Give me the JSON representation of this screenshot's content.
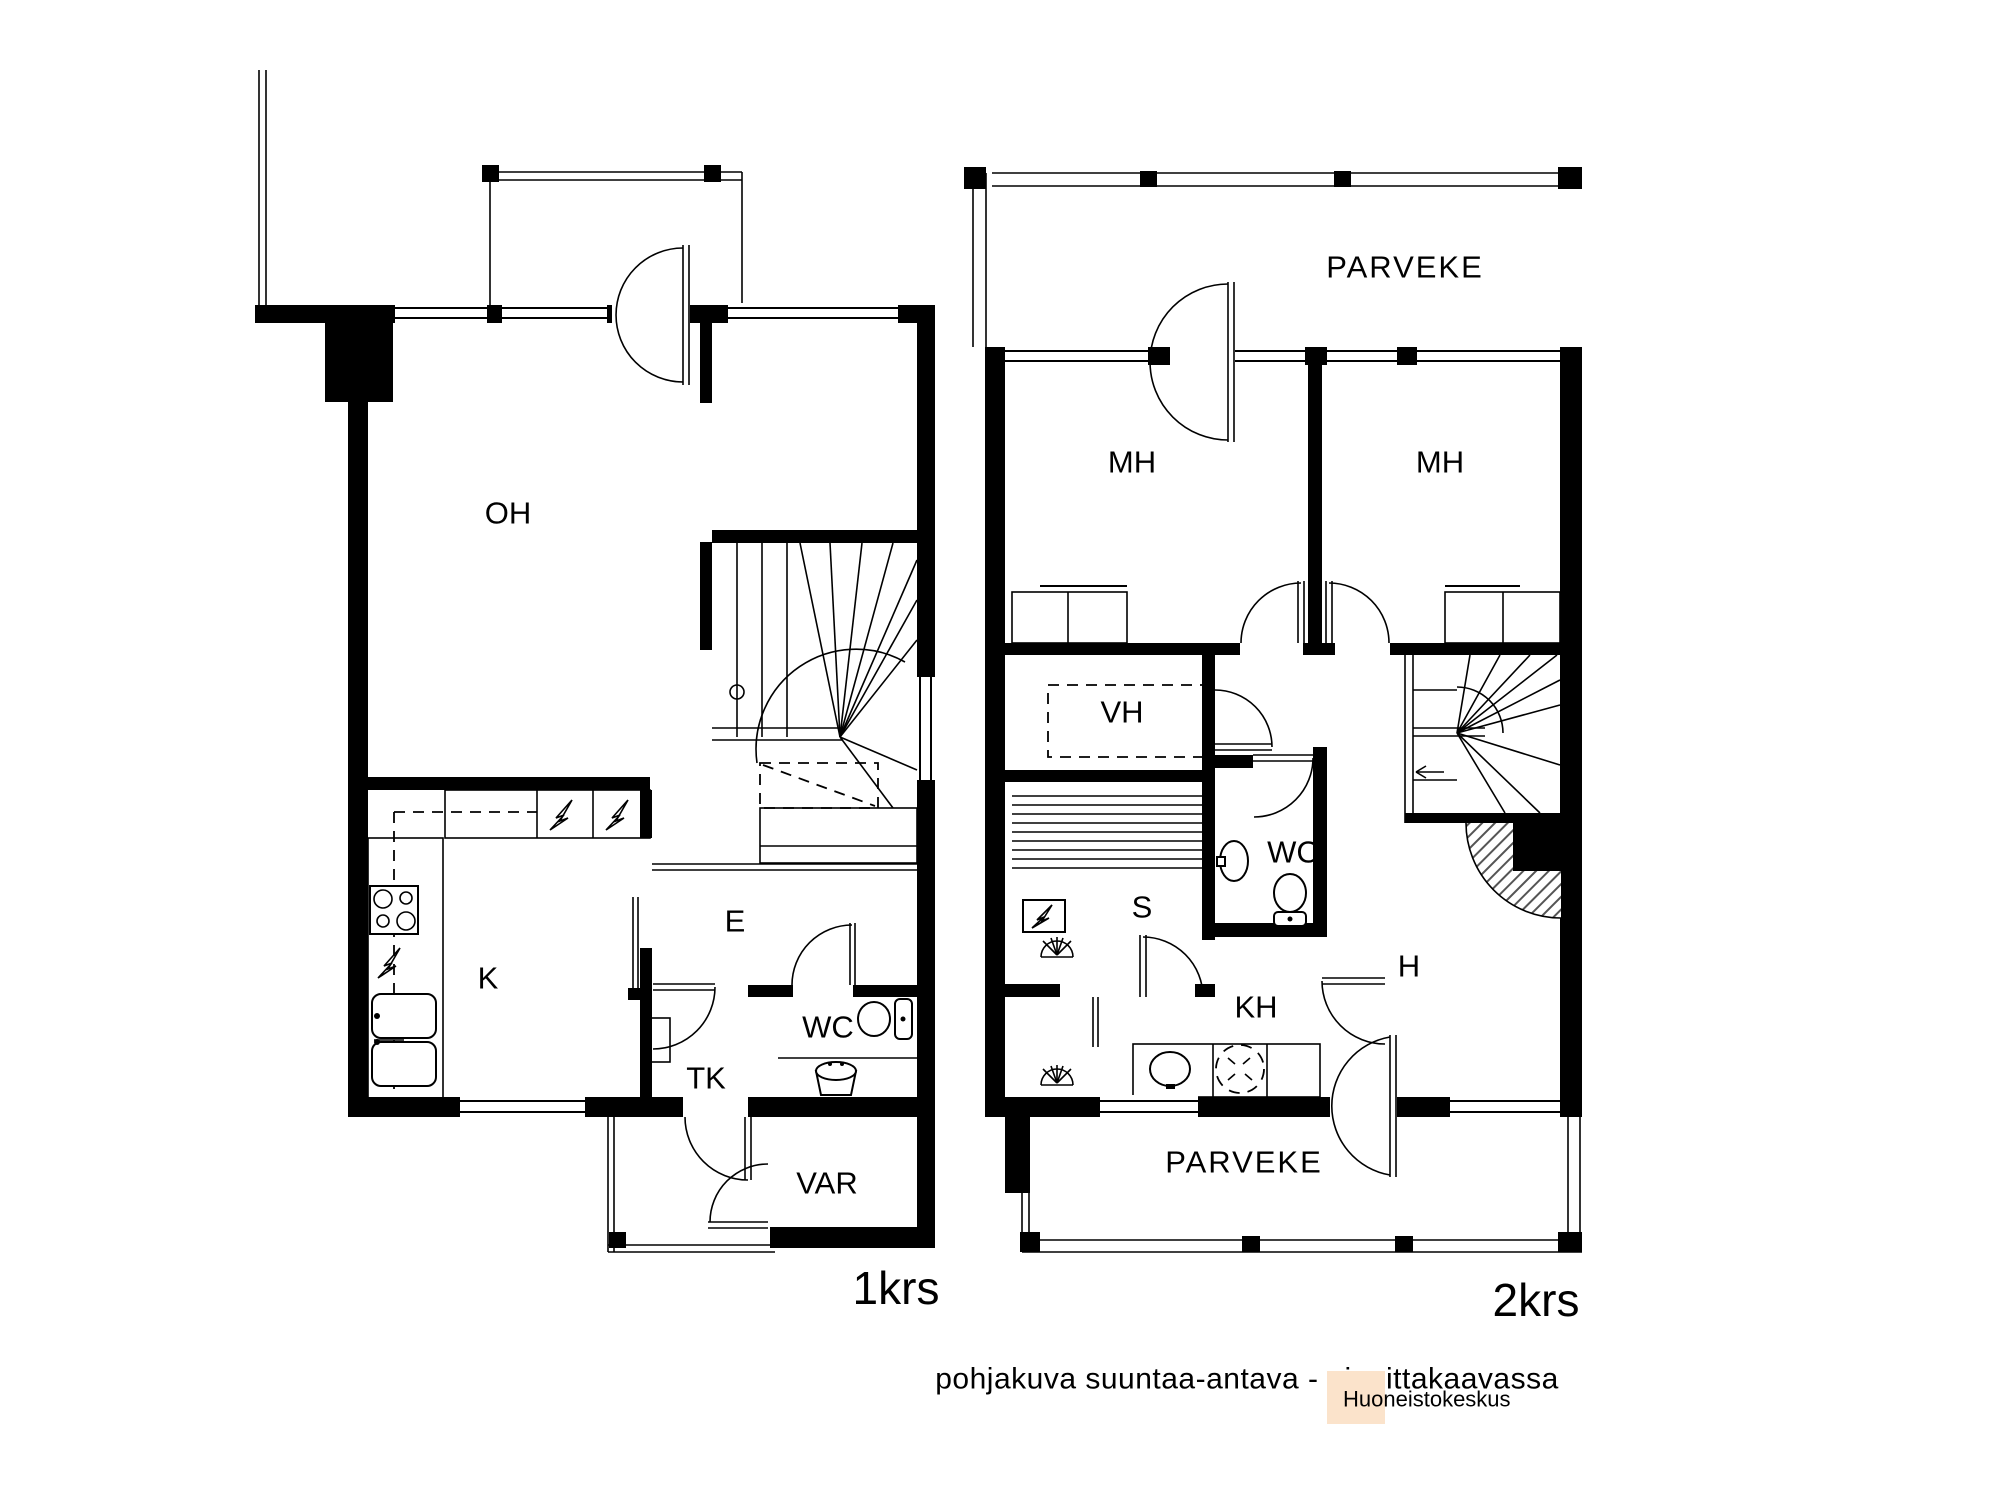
{
  "document": {
    "type": "floorplan",
    "floors_count": "2"
  },
  "floor1": {
    "label": "1krs",
    "rooms": {
      "oh": "OH",
      "k": "K",
      "e": "E",
      "tk": "TK",
      "wc": "WC",
      "var": "VAR"
    }
  },
  "floor2": {
    "label": "2krs",
    "balcony_top": "PARVEKE",
    "balcony_bottom": "PARVEKE",
    "rooms": {
      "mh_left": "MH",
      "mh_right": "MH",
      "vh": "VH",
      "s": "S",
      "wc": "WC",
      "kh": "KH",
      "h": "H"
    }
  },
  "footer": {
    "note": "pohjakuva suuntaa-antava - ei mittakaavassa",
    "note_color": "#a6a6a6",
    "brand": "Huoneistokeskus",
    "brand_color": "#f5791f",
    "brand_bg": "#fbe3cb"
  },
  "icons": {
    "stove": "stove-icon",
    "sink": "sink-icon",
    "toilet": "toilet-icon",
    "basin": "basin-icon",
    "shower": "shower-icon",
    "washing_machine": "washing-machine-icon",
    "electric_appliance": "lightning-icon",
    "sauna_heater": "sauna-heater-icon"
  },
  "plan_colors": {
    "wall": "#000000",
    "hatch": "#555555",
    "background": "#ffffff"
  }
}
